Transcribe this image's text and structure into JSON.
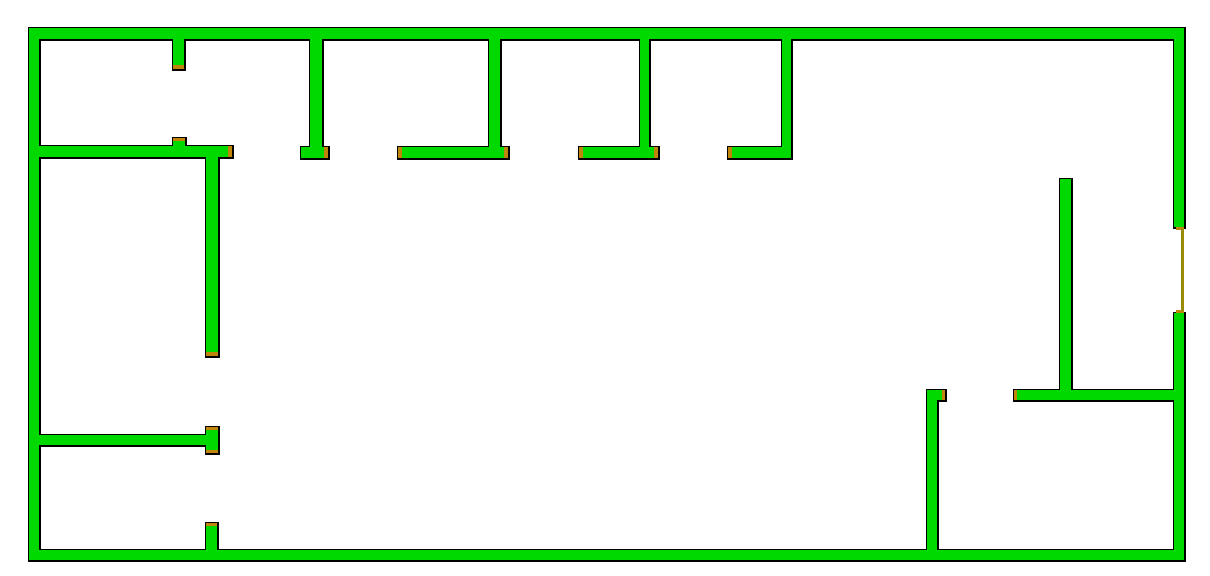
{
  "app": {
    "title": "floor-plan-map"
  },
  "canvas": {
    "width": 1210,
    "height": 576,
    "background": "#ffffff"
  },
  "colors": {
    "wall_fill": "#00d900",
    "wall_outline": "#000000",
    "door_cap": "#bf860b",
    "door_line": "#9a8a00"
  },
  "floorplan": {
    "walls": [
      {
        "id": "wall-top",
        "x": 29,
        "y": 28,
        "w": 1155,
        "h": 11
      },
      {
        "id": "wall-left",
        "x": 29,
        "y": 28,
        "w": 10,
        "h": 532
      },
      {
        "id": "wall-bottom",
        "x": 29,
        "y": 550,
        "w": 1155,
        "h": 10
      },
      {
        "id": "wall-right-upper",
        "x": 1174,
        "y": 28,
        "w": 10,
        "h": 199
      },
      {
        "id": "wall-right-lower",
        "x": 1174,
        "y": 313,
        "w": 10,
        "h": 247
      },
      {
        "id": "stub-room1-door",
        "x": 173,
        "y": 39,
        "w": 11,
        "h": 30
      },
      {
        "id": "wall-room1-south",
        "x": 38,
        "y": 146,
        "w": 194,
        "h": 11
      },
      {
        "id": "bump-room1-door",
        "x": 173,
        "y": 138,
        "w": 12,
        "h": 9
      },
      {
        "id": "partition-1",
        "x": 310,
        "y": 39,
        "w": 12,
        "h": 109
      },
      {
        "id": "foot-1",
        "x": 301,
        "y": 147,
        "w": 27,
        "h": 11
      },
      {
        "id": "partition-2",
        "x": 489,
        "y": 39,
        "w": 11,
        "h": 109
      },
      {
        "id": "foot-2",
        "x": 398,
        "y": 147,
        "w": 110,
        "h": 11
      },
      {
        "id": "partition-3",
        "x": 640,
        "y": 39,
        "w": 9,
        "h": 109
      },
      {
        "id": "foot-3",
        "x": 579,
        "y": 147,
        "w": 79,
        "h": 11
      },
      {
        "id": "partition-4",
        "x": 782,
        "y": 39,
        "w": 9,
        "h": 109
      },
      {
        "id": "foot-4",
        "x": 728,
        "y": 147,
        "w": 63,
        "h": 11
      },
      {
        "id": "wall-midleft-vertical",
        "x": 206,
        "y": 157,
        "w": 12,
        "h": 199
      },
      {
        "id": "wall-lowerleft",
        "x": 38,
        "y": 435,
        "w": 168,
        "h": 10
      },
      {
        "id": "crossbar-lowerleft",
        "x": 206,
        "y": 427,
        "w": 12,
        "h": 26
      },
      {
        "id": "wall-bottomleft-stub",
        "x": 206,
        "y": 523,
        "w": 11,
        "h": 27
      },
      {
        "id": "wall-br-vertical-a",
        "x": 1060,
        "y": 179,
        "w": 11,
        "h": 211
      },
      {
        "id": "wall-br-horizontal",
        "x": 1014,
        "y": 390,
        "w": 170,
        "h": 10
      },
      {
        "id": "wall-br-vertical-c",
        "x": 927,
        "y": 390,
        "w": 10,
        "h": 160
      },
      {
        "id": "stub-br-vertical-c",
        "x": 927,
        "y": 390,
        "w": 18,
        "h": 10
      }
    ],
    "door_markers": [
      {
        "id": "door-cap-stub-room1-bottom",
        "kind": "cap",
        "x": 173,
        "y": 65,
        "w": 11,
        "h": 4
      },
      {
        "id": "door-cap-bump-room1-top",
        "kind": "cap",
        "x": 173,
        "y": 138,
        "w": 12,
        "h": 3
      },
      {
        "id": "door-cap-room1-east",
        "kind": "cap",
        "x": 228,
        "y": 146,
        "w": 4,
        "h": 11
      },
      {
        "id": "door-cap-midleft-bottom",
        "kind": "cap",
        "x": 206,
        "y": 352,
        "w": 12,
        "h": 4
      },
      {
        "id": "door-cap-crossbar-top",
        "kind": "cap",
        "x": 206,
        "y": 427,
        "w": 12,
        "h": 3
      },
      {
        "id": "door-cap-crossbar-bottom",
        "kind": "cap",
        "x": 206,
        "y": 450,
        "w": 12,
        "h": 3
      },
      {
        "id": "door-cap-bottomleft-top",
        "kind": "cap",
        "x": 206,
        "y": 523,
        "w": 11,
        "h": 3
      },
      {
        "id": "door-cap-foot1-east",
        "kind": "cap",
        "x": 324,
        "y": 147,
        "w": 4,
        "h": 11
      },
      {
        "id": "door-cap-foot2-west",
        "kind": "cap",
        "x": 398,
        "y": 147,
        "w": 4,
        "h": 11
      },
      {
        "id": "door-cap-foot2-east",
        "kind": "cap",
        "x": 504,
        "y": 147,
        "w": 4,
        "h": 11
      },
      {
        "id": "door-cap-foot3-west",
        "kind": "cap",
        "x": 579,
        "y": 147,
        "w": 4,
        "h": 11
      },
      {
        "id": "door-cap-foot3-east",
        "kind": "cap",
        "x": 654,
        "y": 147,
        "w": 4,
        "h": 11
      },
      {
        "id": "door-cap-foot4-west",
        "kind": "cap",
        "x": 728,
        "y": 147,
        "w": 4,
        "h": 11
      },
      {
        "id": "door-cap-br-horizontal-west",
        "kind": "cap",
        "x": 1014,
        "y": 390,
        "w": 3,
        "h": 10
      },
      {
        "id": "door-cap-br-stub-east",
        "kind": "cap",
        "x": 942,
        "y": 390,
        "w": 3,
        "h": 10
      },
      {
        "id": "door-tick-right-top",
        "kind": "cap",
        "x": 1176,
        "y": 227,
        "w": 8,
        "h": 3
      },
      {
        "id": "door-tick-right-bottom",
        "kind": "cap",
        "x": 1176,
        "y": 310,
        "w": 8,
        "h": 3
      },
      {
        "id": "door-line-right-wall",
        "kind": "line",
        "x": 1181,
        "y": 229,
        "w": 3,
        "h": 82
      }
    ]
  }
}
